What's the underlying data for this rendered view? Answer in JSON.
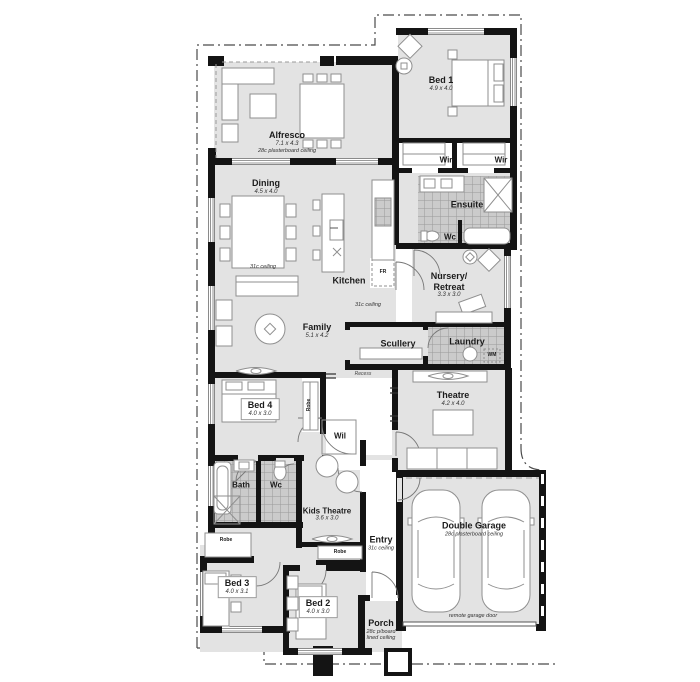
{
  "rooms": {
    "alfresco": {
      "label": "Alfresco",
      "dims": "7.1 x 4.3",
      "note": "28c plasterboard ceiling"
    },
    "dining": {
      "label": "Dining",
      "dims": "4.5 x 4.0"
    },
    "kitchen": {
      "label": "Kitchen"
    },
    "family": {
      "label": "Family",
      "dims": "5.1 x 4.2"
    },
    "bed1": {
      "label": "Bed 1",
      "dims": "4.9 x 4.0"
    },
    "wir_left": {
      "label": "Wir"
    },
    "wir_right": {
      "label": "Wir"
    },
    "ensuite": {
      "label": "Ensuite"
    },
    "ensuite_wc": {
      "label": "Wc"
    },
    "nursery": {
      "label": "Nursery/\nRetreat",
      "dims": "3.3 x 3.0"
    },
    "scullery": {
      "label": "Scullery"
    },
    "laundry": {
      "label": "Laundry"
    },
    "theatre": {
      "label": "Theatre",
      "dims": "4.2 x 4.0"
    },
    "bed4": {
      "label": "Bed 4",
      "dims": "4.0 x 3.0"
    },
    "wil": {
      "label": "Wil"
    },
    "bath": {
      "label": "Bath"
    },
    "wc": {
      "label": "Wc"
    },
    "kids_theatre": {
      "label": "Kids Theatre",
      "dims": "3.6 x 3.0"
    },
    "bed3": {
      "label": "Bed 3",
      "dims": "4.0 x 3.1"
    },
    "bed2": {
      "label": "Bed 2",
      "dims": "4.0 x 3.0"
    },
    "entry": {
      "label": "Entry",
      "note": "31c ceiling"
    },
    "porch": {
      "label": "Porch",
      "note": "28c p/board\nlined ceiling"
    },
    "garage": {
      "label": "Double Garage",
      "note": "28c plasterboard ceiling",
      "door_note": "remote garage door"
    }
  },
  "annotations": {
    "ceiling_dining": "31c ceiling",
    "ceiling_family": "31c ceiling",
    "recess": "Recess",
    "fridge": "FR",
    "washing_machine": "WM",
    "robe_bed4": "Robe",
    "robe_hall": "Robe",
    "robe_kids": "Robe"
  },
  "colors": {
    "floor": "#e3e3e3",
    "wall": "#141414",
    "tile": "#cbcbcb",
    "tile_line": "#9a9a9a",
    "furniture_line": "#8f8f8f",
    "boundary": "#4a4a4a",
    "text": "#1b1b1b"
  }
}
